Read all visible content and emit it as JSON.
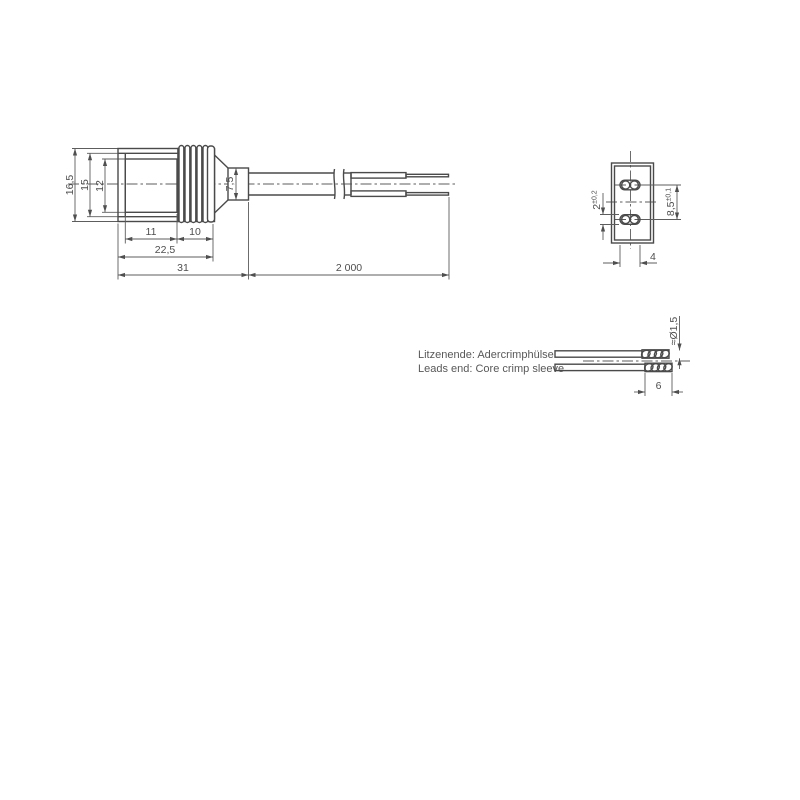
{
  "meta": {
    "background": "#ffffff",
    "line_color": "#4a4a4a",
    "dim_color": "#5d5d5d",
    "text_color": "#4e4e4e"
  },
  "side_view": {
    "dim_height_outer": "16,5",
    "dim_height_step": "15",
    "dim_height_face": "12",
    "dim_face_length": "11",
    "dim_rib_length": "10",
    "dim_front_length": "22,5",
    "dim_connector_length": "31",
    "dim_cable_length": "2 000",
    "dim_boot_diameter": "7,5"
  },
  "end_view": {
    "dim_slot_height": "2",
    "dim_slot_height_tolerance": "±0,2",
    "dim_contact_pitch": "8,5",
    "dim_contact_pitch_tolerance": "±0,1",
    "dim_slot_width": "4"
  },
  "detail_view": {
    "note_line1": "Litzenende: Adercrimphülse",
    "note_line2": "Leads end: Core crimp sleeve",
    "dim_sleeve_diameter": "≈Ø1,5",
    "dim_sleeve_length": "6"
  }
}
